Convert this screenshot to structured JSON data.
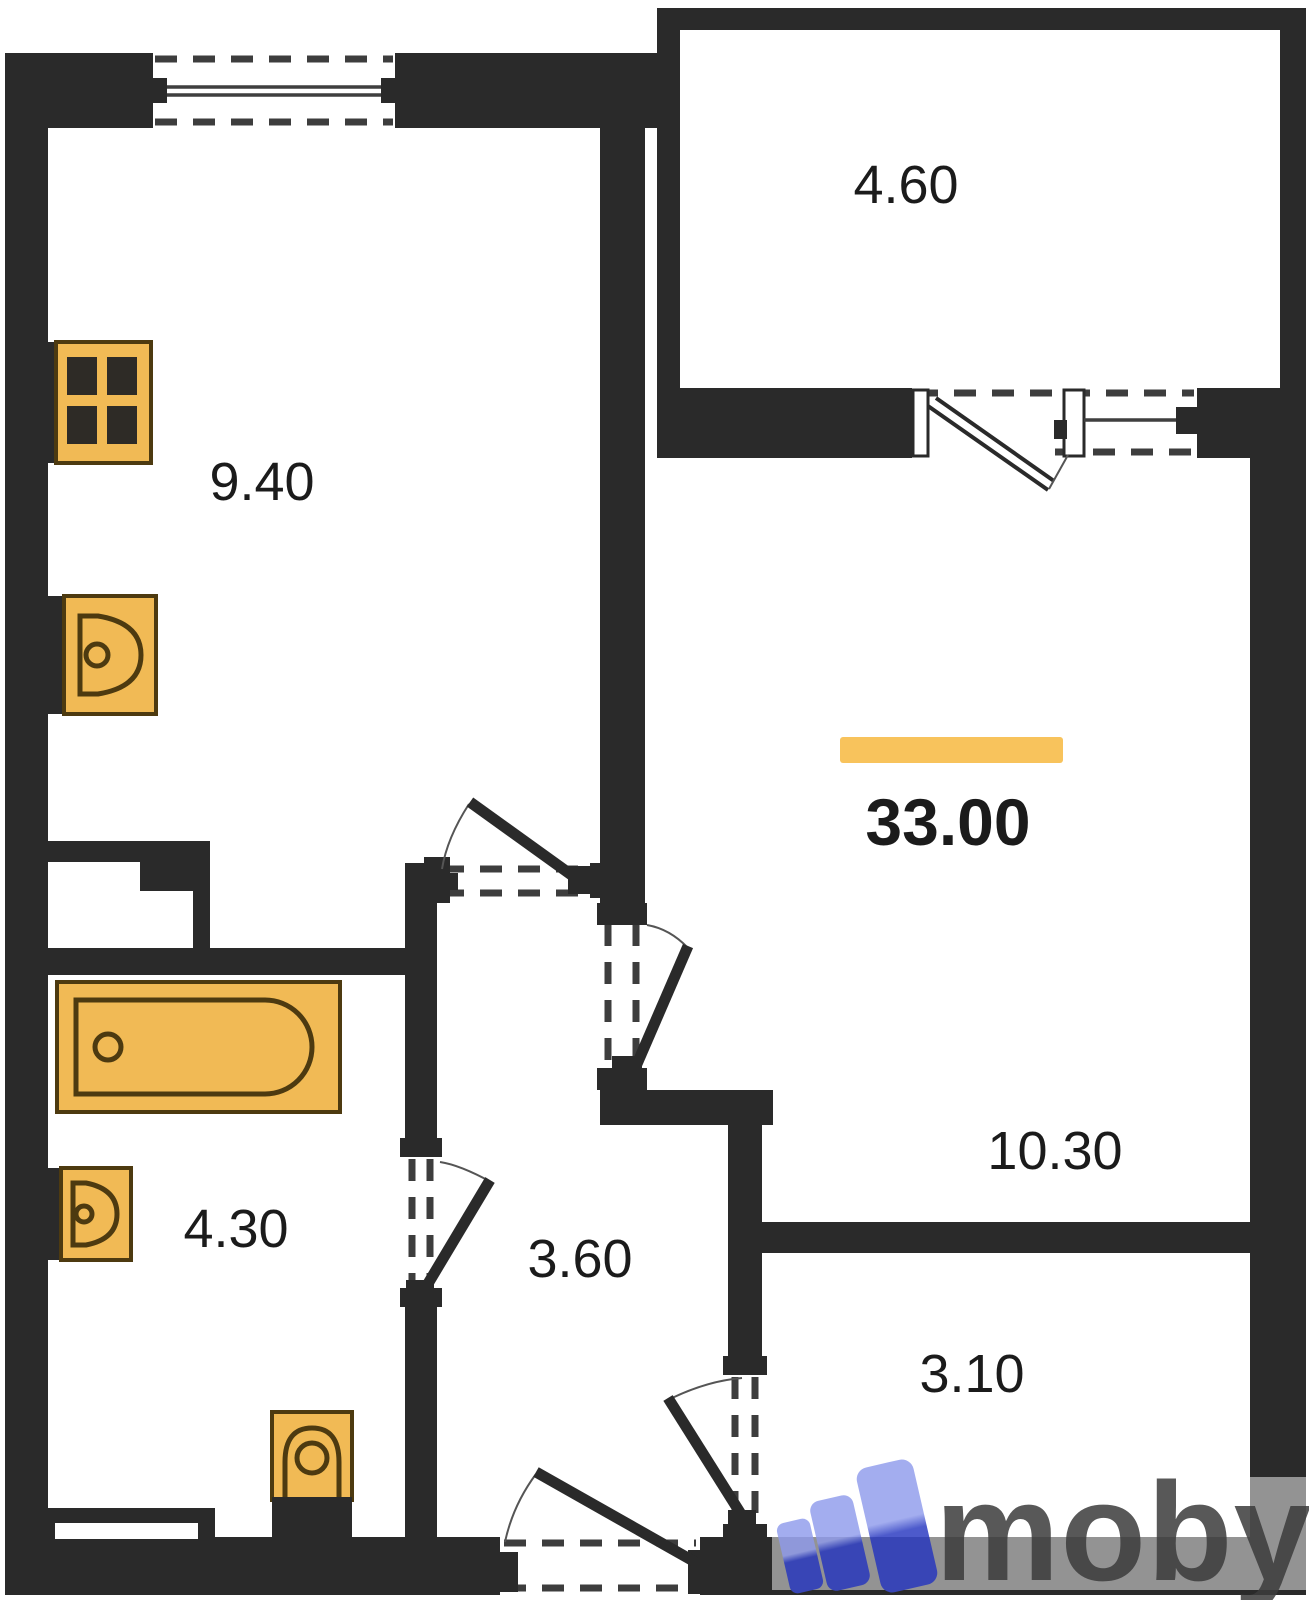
{
  "plan": {
    "total_area": "33.00",
    "rooms": [
      {
        "name": "balcony",
        "area": "4.60"
      },
      {
        "name": "kitchen",
        "area": "9.40"
      },
      {
        "name": "living-room",
        "area": "10.30"
      },
      {
        "name": "bathroom",
        "area": "4.30"
      },
      {
        "name": "hallway",
        "area": "3.60"
      },
      {
        "name": "entry-room",
        "area": "3.10"
      }
    ],
    "fixtures": [
      "stove",
      "kitchen-sink",
      "bathtub",
      "bathroom-sink",
      "toilet",
      "vent-shaft"
    ],
    "colors": {
      "wall": "#2a2a2a",
      "fixture": "#f1ba55",
      "fixture-outline": "#4d3a10",
      "highlight": "#f8c35c",
      "label": "#1b1b1b",
      "logo-blue-light": "#9aa5ee",
      "logo-blue-dark": "#3a49c6",
      "logo-text": "#3c3c3c"
    }
  },
  "watermark": {
    "brand": "moby"
  }
}
